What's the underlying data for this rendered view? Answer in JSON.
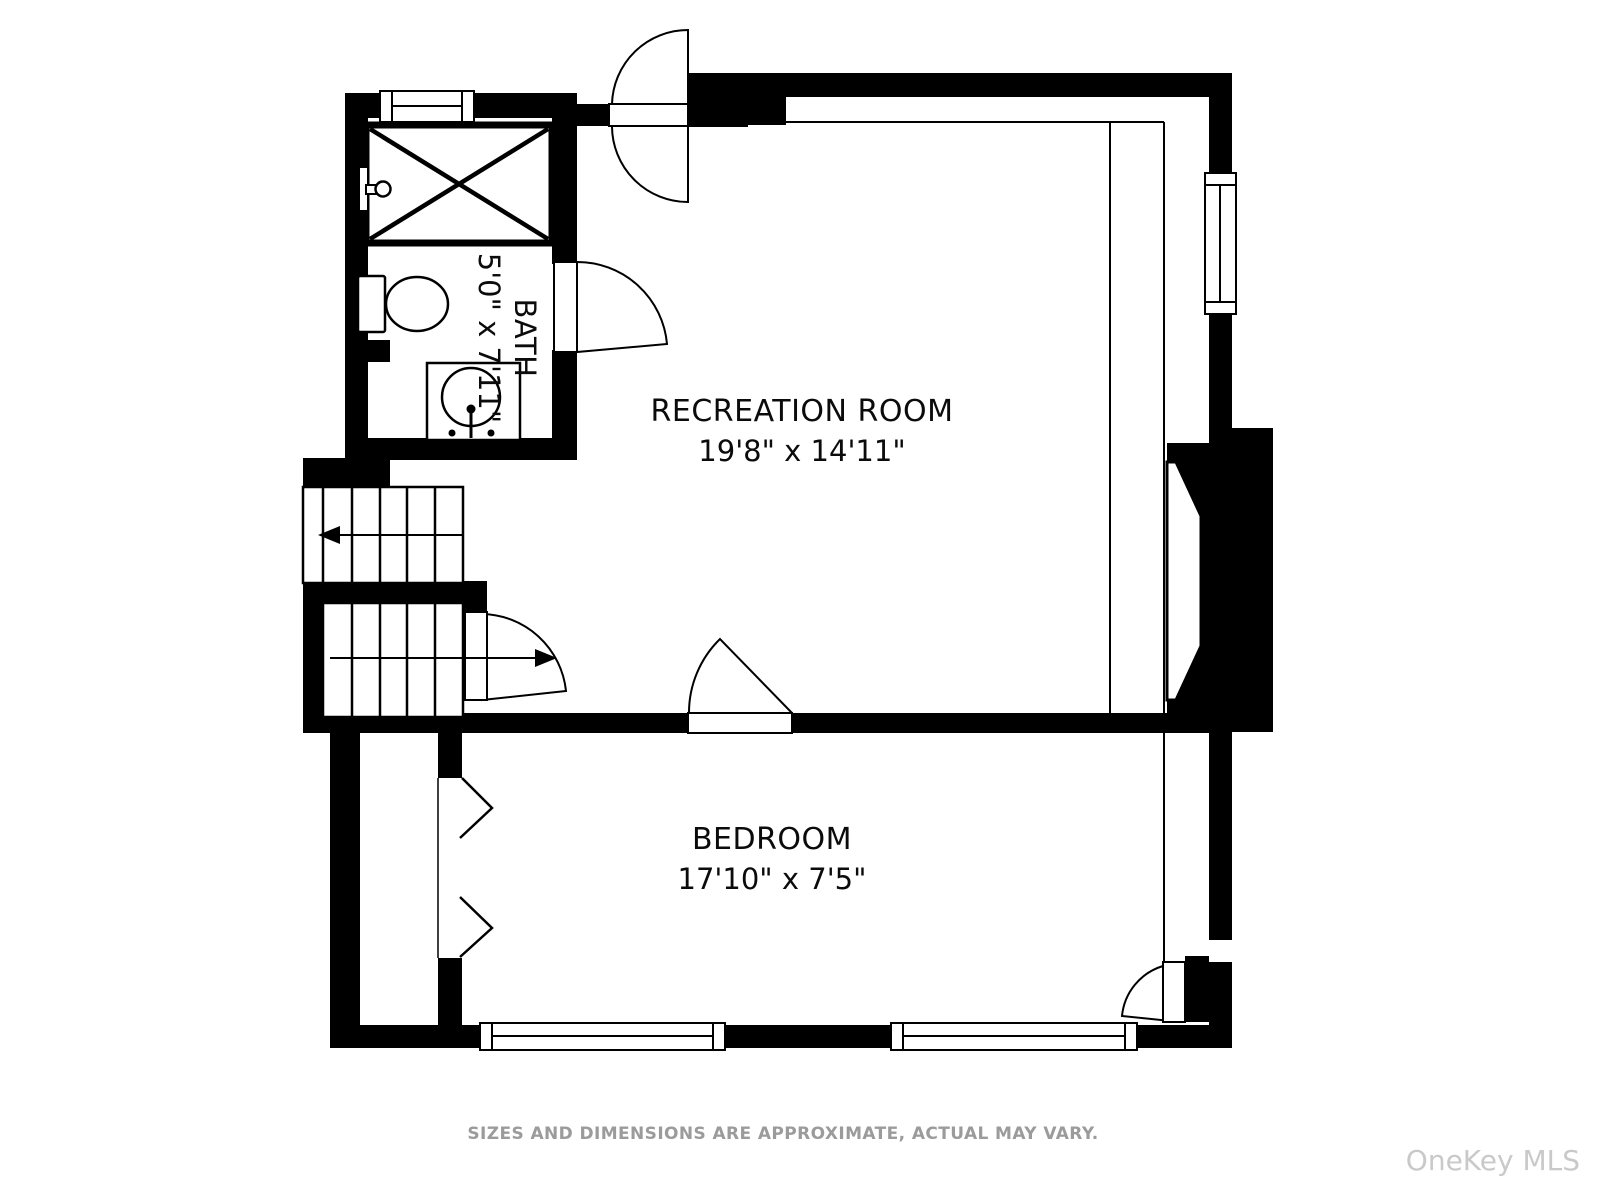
{
  "floorplan": {
    "rooms": [
      {
        "name": "RECREATION ROOM",
        "dimensions": "19'8\" x 14'11\""
      },
      {
        "name": "BEDROOM",
        "dimensions": "17'10\" x 7'5\""
      },
      {
        "name": "BATH",
        "dimensions": "5'0\" x 7'11\""
      }
    ],
    "footer": {
      "disclaimer": "SIZES AND DIMENSIONS ARE APPROXIMATE, ACTUAL MAY VARY."
    },
    "watermark": "OneKey MLS",
    "colors": {
      "wall": "#000000",
      "floor": "#ffffff",
      "disclaimer_text": "#9b9b9b",
      "watermark_text": "#c9c9c9"
    },
    "fixtures": [
      "shower",
      "toilet",
      "pedestal-sink",
      "fireplace",
      "stairs-up",
      "stairs-down"
    ]
  }
}
